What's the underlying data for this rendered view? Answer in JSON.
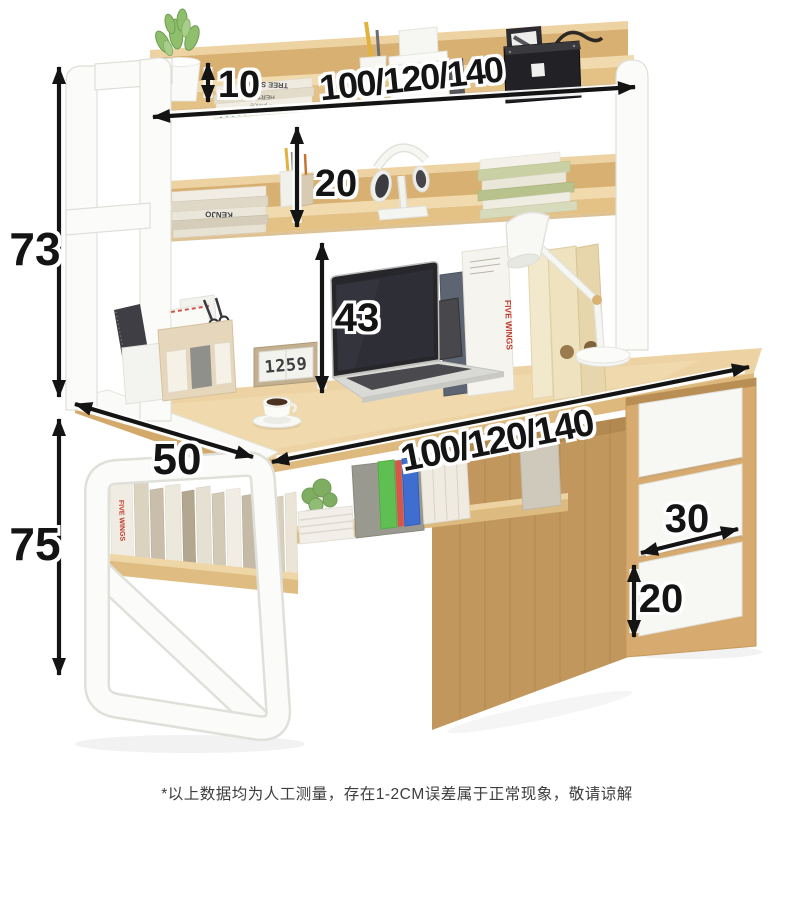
{
  "meta": {
    "description": "Product dimension diagram: wooden computer desk with bookshelf hutch and three drawers"
  },
  "dimensions": {
    "hutch_height": "73",
    "top_shelf_gap": "10",
    "shelf_width_options": "100/120/140",
    "middle_shelf_gap": "20",
    "under_hutch_clearance": "43",
    "desk_width_options": "100/120/140",
    "desk_depth": "50",
    "desk_height": "75",
    "drawer_width": "30",
    "drawer_height": "20"
  },
  "footnote": "*以上数据均为人工测量，存在1-2CM误差属于正常现象，敬请谅解",
  "decor": {
    "clock_display": "1259",
    "book_spine_kenjo": "KENJO",
    "book_spine_tree_scout": "TREE SCOUT",
    "book_spine_hertz": "HERTZ",
    "book_spine_police": "the police",
    "book_spine_five_wings": "FIVE WINGS"
  },
  "colors": {
    "wood_light": "#EFD7A8",
    "wood_mid": "#E3C084",
    "wood_dark": "#C1975D",
    "frame_white": "#FBFBFA",
    "annotation": "#141414",
    "background": "#FFFFFF"
  }
}
